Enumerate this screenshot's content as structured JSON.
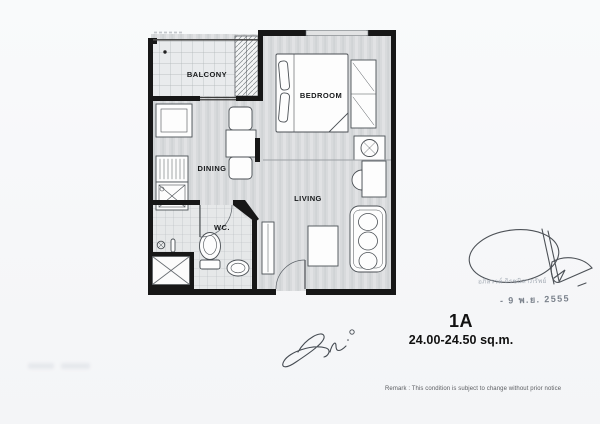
{
  "unit": {
    "code": "1A",
    "area": "24.00-24.50 sq.m."
  },
  "rooms": {
    "balcony": "BALCONY",
    "bedroom": "BEDROOM",
    "dining": "DINING",
    "living": "LIVING",
    "wc": "WC."
  },
  "remark": "Remark : This condition is subject to change without prior notice",
  "stamps": {
    "signer_name": "อภิสรรค์ ถิรชนิลาภรัพย์",
    "approval_date": "- 9 พ.ย. 2555"
  },
  "icons": {
    "signature": "handwritten-approval-signature",
    "initials": "handwritten-initials-mark"
  },
  "colors": {
    "paper": "#f7f8f9",
    "wall": "#171717",
    "floor": "#d8dadc",
    "balcony_tile": "#e9ebed",
    "wc_tile": "#e6e8e9",
    "furniture": "#fdfdfd",
    "label_text": "#17191b"
  }
}
